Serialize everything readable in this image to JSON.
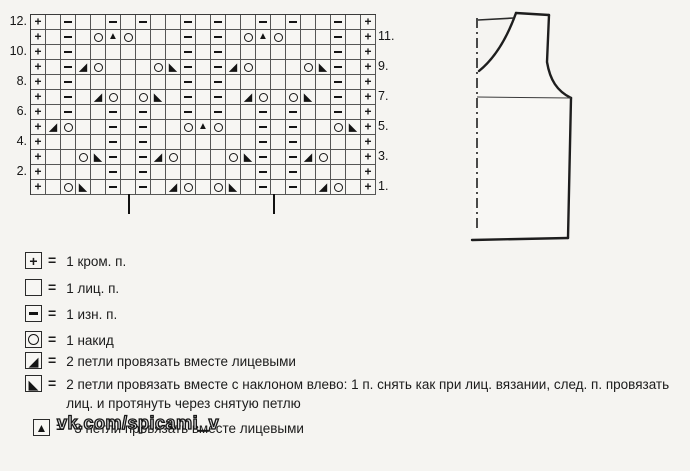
{
  "page": {
    "background": "#f5f4f1",
    "ink": "#1b1b1b"
  },
  "chart": {
    "title_hint": "lace stitch chart",
    "columns": 23,
    "rows_top_to_bottom": [
      "+.-..-.-..-.-..-.-..-.+",
      "+.-.OTO...-.-.OTO...-.+",
      "+.-.......-.-.......-.+",
      "+.-AO...OB-.-AO...OB-.+",
      "+.-.......-.-.......-.+",
      "+.-.AO.OB.-.-.AO.OB.-.+",
      "+.-..-.-..-.-..-.-..-.+",
      "+AO..-.-..OTO..-.-..OB+",
      "+....-.-.......-.-....+",
      "+..OB-.-AO...OB-.-AO..+",
      "+....-.-.......-.-....+",
      "+.OB.-.-.AO.OB.-.-.AO.+"
    ],
    "left_row_labels": [
      "12.",
      "10.",
      "8.",
      "6.",
      "4.",
      "2."
    ],
    "right_row_labels": [
      "11.",
      "9.",
      "7.",
      "5.",
      "3.",
      "1."
    ],
    "symbol_semantics": {
      "+": "edge-stitch",
      ".": "knit-stitch-empty-cell",
      "-": "purl-stitch",
      "O": "yarn-over",
      "A": "k2tog-lower-right-triangle",
      "B": "left-slip-decrease-lower-left-triangle",
      "T": "triple-decrease-up-triangle"
    },
    "repeat_tick_marks_x": [
      128,
      273
    ]
  },
  "legend": {
    "equals_sign": "=",
    "items": [
      {
        "symbol": "+",
        "text": "1 кром. п."
      },
      {
        "symbol": ".",
        "text": "1 лиц. п."
      },
      {
        "symbol": "-",
        "text": "1 изн. п."
      },
      {
        "symbol": "O",
        "text": "1 накид"
      },
      {
        "symbol": "A",
        "text": "2 петли провязать вместе лицевыми"
      },
      {
        "symbol": "B",
        "text": "2 петли провязать вместе с наклоном влево: 1 п. снять как при лиц. вязании, след. п. провязать лиц. и протянуть через снятую петлю"
      },
      {
        "symbol": "T",
        "text": "3 петли провязать вместе лицевыми"
      }
    ]
  },
  "watermark": {
    "text": "vk.com/spicami_v"
  },
  "schematic": {
    "description": "garment front piece outline with center fold dash-dot line, underarm line and back-neck line"
  }
}
